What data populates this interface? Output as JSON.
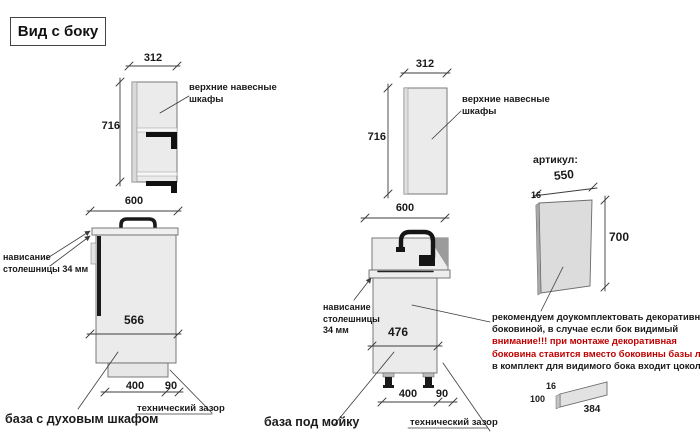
{
  "title": "Вид с боку",
  "colors": {
    "warning_red": "#c00000",
    "line_dark": "#3c3c3c",
    "cabinet_fill": "#ebebeb"
  },
  "wall_cabinet_left": {
    "width_dim": "312",
    "height_dim": "716",
    "label": "верхние навесные шкафы"
  },
  "oven_base": {
    "top_dim": "600",
    "inner_dim": "566",
    "plinth_dim": "400",
    "gap_dim": "90",
    "overhang_line1": "нависание",
    "overhang_line2": "столешницы 34 мм",
    "gap_label": "технический зазор",
    "caption": "база с духовым шкафом"
  },
  "wall_cabinet_middle": {
    "width_dim": "312",
    "height_dim": "716",
    "label": "верхние навесные шкафы"
  },
  "sink_base": {
    "top_dim": "600",
    "inner_dim": "476",
    "plinth_dim": "400",
    "gap_dim": "90",
    "overhang_line1": "нависание",
    "overhang_line2": "столешницы",
    "overhang_line3": "34 мм",
    "gap_label": "технический зазор",
    "caption": "база под мойку"
  },
  "side_panel": {
    "heading": "артикул:",
    "width_dim": "550",
    "thickness_dim": "16",
    "height_dim": "700"
  },
  "note": {
    "line1": "рекомендуем доукомплектовать декоративной",
    "line2": "боковиной, в случае если бок видимый",
    "line3": "внимание!!! при монтаже декоративная",
    "line4": "боковина ставится вместо боковины базы лдсп",
    "line5": "в комплект для видимого бока входит цоколь:"
  },
  "plinth": {
    "thickness_dim": "16",
    "height_dim": "100",
    "length_dim": "384"
  }
}
